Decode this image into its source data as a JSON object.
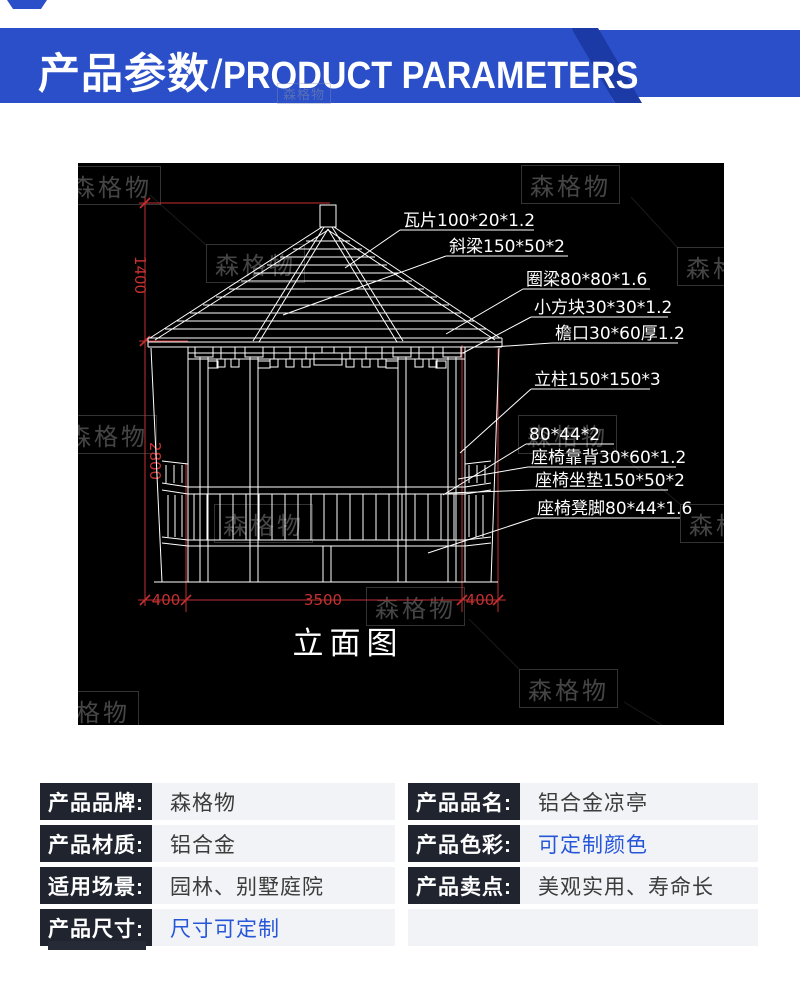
{
  "header": {
    "title_cn": "产品参数",
    "divider": "/",
    "title_en": "PRODUCT PARAMETERS",
    "accent_color": "#2a4fc8",
    "shadow_color": "#1c3aa5"
  },
  "drawing": {
    "title": "立面图",
    "watermark": "森格物",
    "line_color": "#ffffff",
    "dim_color": "#c53030",
    "annotations": [
      {
        "label": "瓦片100*20*1.2"
      },
      {
        "label": "斜梁150*50*2"
      },
      {
        "label": "圈梁80*80*1.6"
      },
      {
        "label": "小方块30*30*1.2"
      },
      {
        "label": "檐口30*60厚1.2"
      },
      {
        "label": "立柱150*150*3"
      },
      {
        "label": "80*44*2"
      },
      {
        "label": "座椅靠背30*60*1.2"
      },
      {
        "label": "座椅坐垫150*50*2"
      },
      {
        "label": "座椅凳脚80*44*1.6"
      }
    ],
    "dimensions": {
      "height_upper": "1400",
      "height_lower": "2800",
      "bottom_left": "400",
      "bottom_center": "3500",
      "bottom_right": "400"
    }
  },
  "specs": {
    "left": [
      {
        "label": "产品品牌:",
        "value": "森格物"
      },
      {
        "label": "产品材质:",
        "value": "铝合金"
      },
      {
        "label": "适用场景:",
        "value": "园林、别墅庭院"
      },
      {
        "label": "产品尺寸:",
        "value": "尺寸可定制"
      }
    ],
    "right": [
      {
        "label": "产品品名:",
        "value": "铝合金凉亭"
      },
      {
        "label": "产品色彩:",
        "value": "可定制颜色"
      },
      {
        "label": "产品卖点:",
        "value": "美观实用、寿命长"
      }
    ]
  }
}
